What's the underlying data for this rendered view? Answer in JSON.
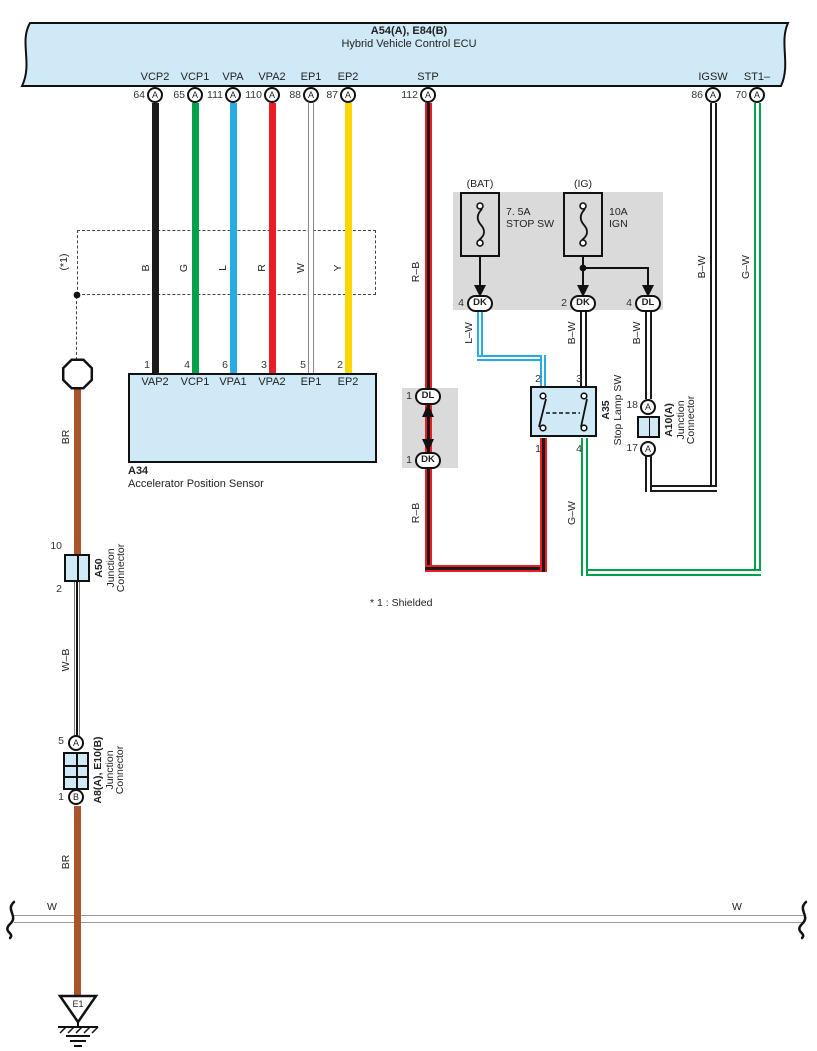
{
  "ecu": {
    "title": "A54(A), E84(B)",
    "name": "Hybrid Vehicle Control ECU",
    "pins": [
      {
        "label": "VCP2",
        "number": "64",
        "terminal": "A"
      },
      {
        "label": "VCP1",
        "number": "65",
        "terminal": "A"
      },
      {
        "label": "VPA",
        "number": "111",
        "terminal": "A"
      },
      {
        "label": "VPA2",
        "number": "110",
        "terminal": "A"
      },
      {
        "label": "EP1",
        "number": "88",
        "terminal": "A"
      },
      {
        "label": "EP2",
        "number": "87",
        "terminal": "A"
      },
      {
        "label": "STP",
        "number": "112",
        "terminal": "A"
      },
      {
        "label": "IGSW",
        "number": "86",
        "terminal": "A"
      },
      {
        "label": "ST1–",
        "number": "70",
        "terminal": "A"
      }
    ]
  },
  "shield": {
    "label": "(*1)",
    "footnote": "* 1 : Shielded"
  },
  "wire_labels": {
    "b": "B",
    "g": "G",
    "l": "L",
    "r": "R",
    "w": "W",
    "y": "Y",
    "rb_top": "R–B",
    "rb_bottom": "R–B",
    "lw": "L–W",
    "bw_stop": "B–W",
    "bw_dl": "B–W",
    "bw_igsw": "B–W",
    "gw_right": "G–W",
    "gw_bottom": "G–W",
    "br_top": "BR",
    "wb": "W–B",
    "br_bottom": "BR",
    "w_left": "W",
    "w_right": "W"
  },
  "fuses": {
    "bat": {
      "source": "(BAT)",
      "rating": "7. 5A",
      "name": "STOP SW",
      "out_pin": "4",
      "out_terminal": "DK"
    },
    "ig": {
      "source": "(IG)",
      "rating": "10A",
      "name": "IGN",
      "out1_pin": "2",
      "out1_terminal": "DK",
      "out2_pin": "4",
      "out2_terminal": "DL"
    }
  },
  "inline_connector": {
    "top_pin": "1",
    "top_terminal": "DL",
    "bottom_pin": "1",
    "bottom_terminal": "DK"
  },
  "a34": {
    "id": "A34",
    "name": "Accelerator Position Sensor",
    "pins": [
      {
        "number": "1",
        "label": "VAP2"
      },
      {
        "number": "4",
        "label": "VCP1"
      },
      {
        "number": "6",
        "label": "VPA1"
      },
      {
        "number": "3",
        "label": "VPA2"
      },
      {
        "number": "5",
        "label": "EP1"
      },
      {
        "number": "2",
        "label": "EP2"
      }
    ]
  },
  "a35": {
    "id": "A35",
    "name": "Stop Lamp SW",
    "pin_tl": "2",
    "pin_tr": "3",
    "pin_bl": "1",
    "pin_br": "4"
  },
  "a10": {
    "id": "A10(A)",
    "name_line1": "Junction",
    "name_line2": "Connector",
    "pin_top": "18",
    "pin_bottom": "17",
    "terminal_top": "A",
    "terminal_bottom": "A"
  },
  "a50": {
    "id": "A50",
    "name_line1": "Junction",
    "name_line2": "Connector",
    "pin_top": "10",
    "pin_bottom": "2"
  },
  "a8": {
    "id": "A8(A), E10(B)",
    "name_line1": "Junction",
    "name_line2": "Connector",
    "pin_top": "5",
    "terminal_top": "A",
    "pin_bottom": "1",
    "terminal_bottom": "B"
  },
  "ground": {
    "id": "E1"
  },
  "colors": {
    "box_fill": "#cfe9f7",
    "panel_gray": "#dadada",
    "wire_black": "#1a1a1a",
    "wire_green": "#00a14b",
    "wire_blue": "#29abe2",
    "wire_red": "#ec1c24",
    "wire_yellow": "#ffd500",
    "wire_brown": "#a8542c",
    "wire_white": "#ffffff"
  }
}
